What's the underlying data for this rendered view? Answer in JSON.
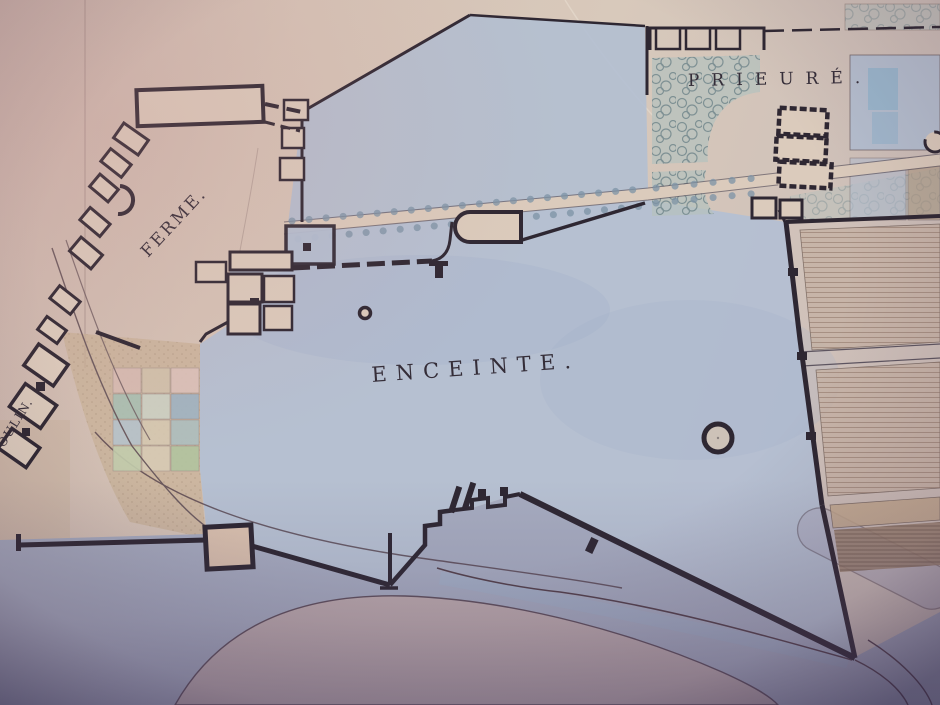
{
  "map": {
    "labels": {
      "ferme": "FERME.",
      "prieure": "PRIEURÉ.",
      "enceinte": "ENCEINTE.",
      "moulin": "OULIN."
    },
    "colors": {
      "paper": "#d3c0b4",
      "paper2": "#dbcbbc",
      "ink": "#2e2732",
      "label": "#342d38",
      "wash": "#b3bfd2",
      "washdeep": "#a2b1c9",
      "flood": "#a3aabf",
      "tan": "#c7b096",
      "island": "#c2abaa",
      "bank": "#53404a",
      "tree": "#7d93a6",
      "bosquet": "#b6c1bd",
      "brownplot": "#9b8370"
    },
    "plot_colors": [
      "#d8bcb4",
      "#d2c3ad",
      "#dcc3bb",
      "#a9c0b3",
      "#cdd2c5",
      "#9fb4c4",
      "#b6c4cc",
      "#d6c9b2",
      "#aebfc0",
      "#c3cdad",
      "#d8cbb5",
      "#b2c49f"
    ]
  }
}
